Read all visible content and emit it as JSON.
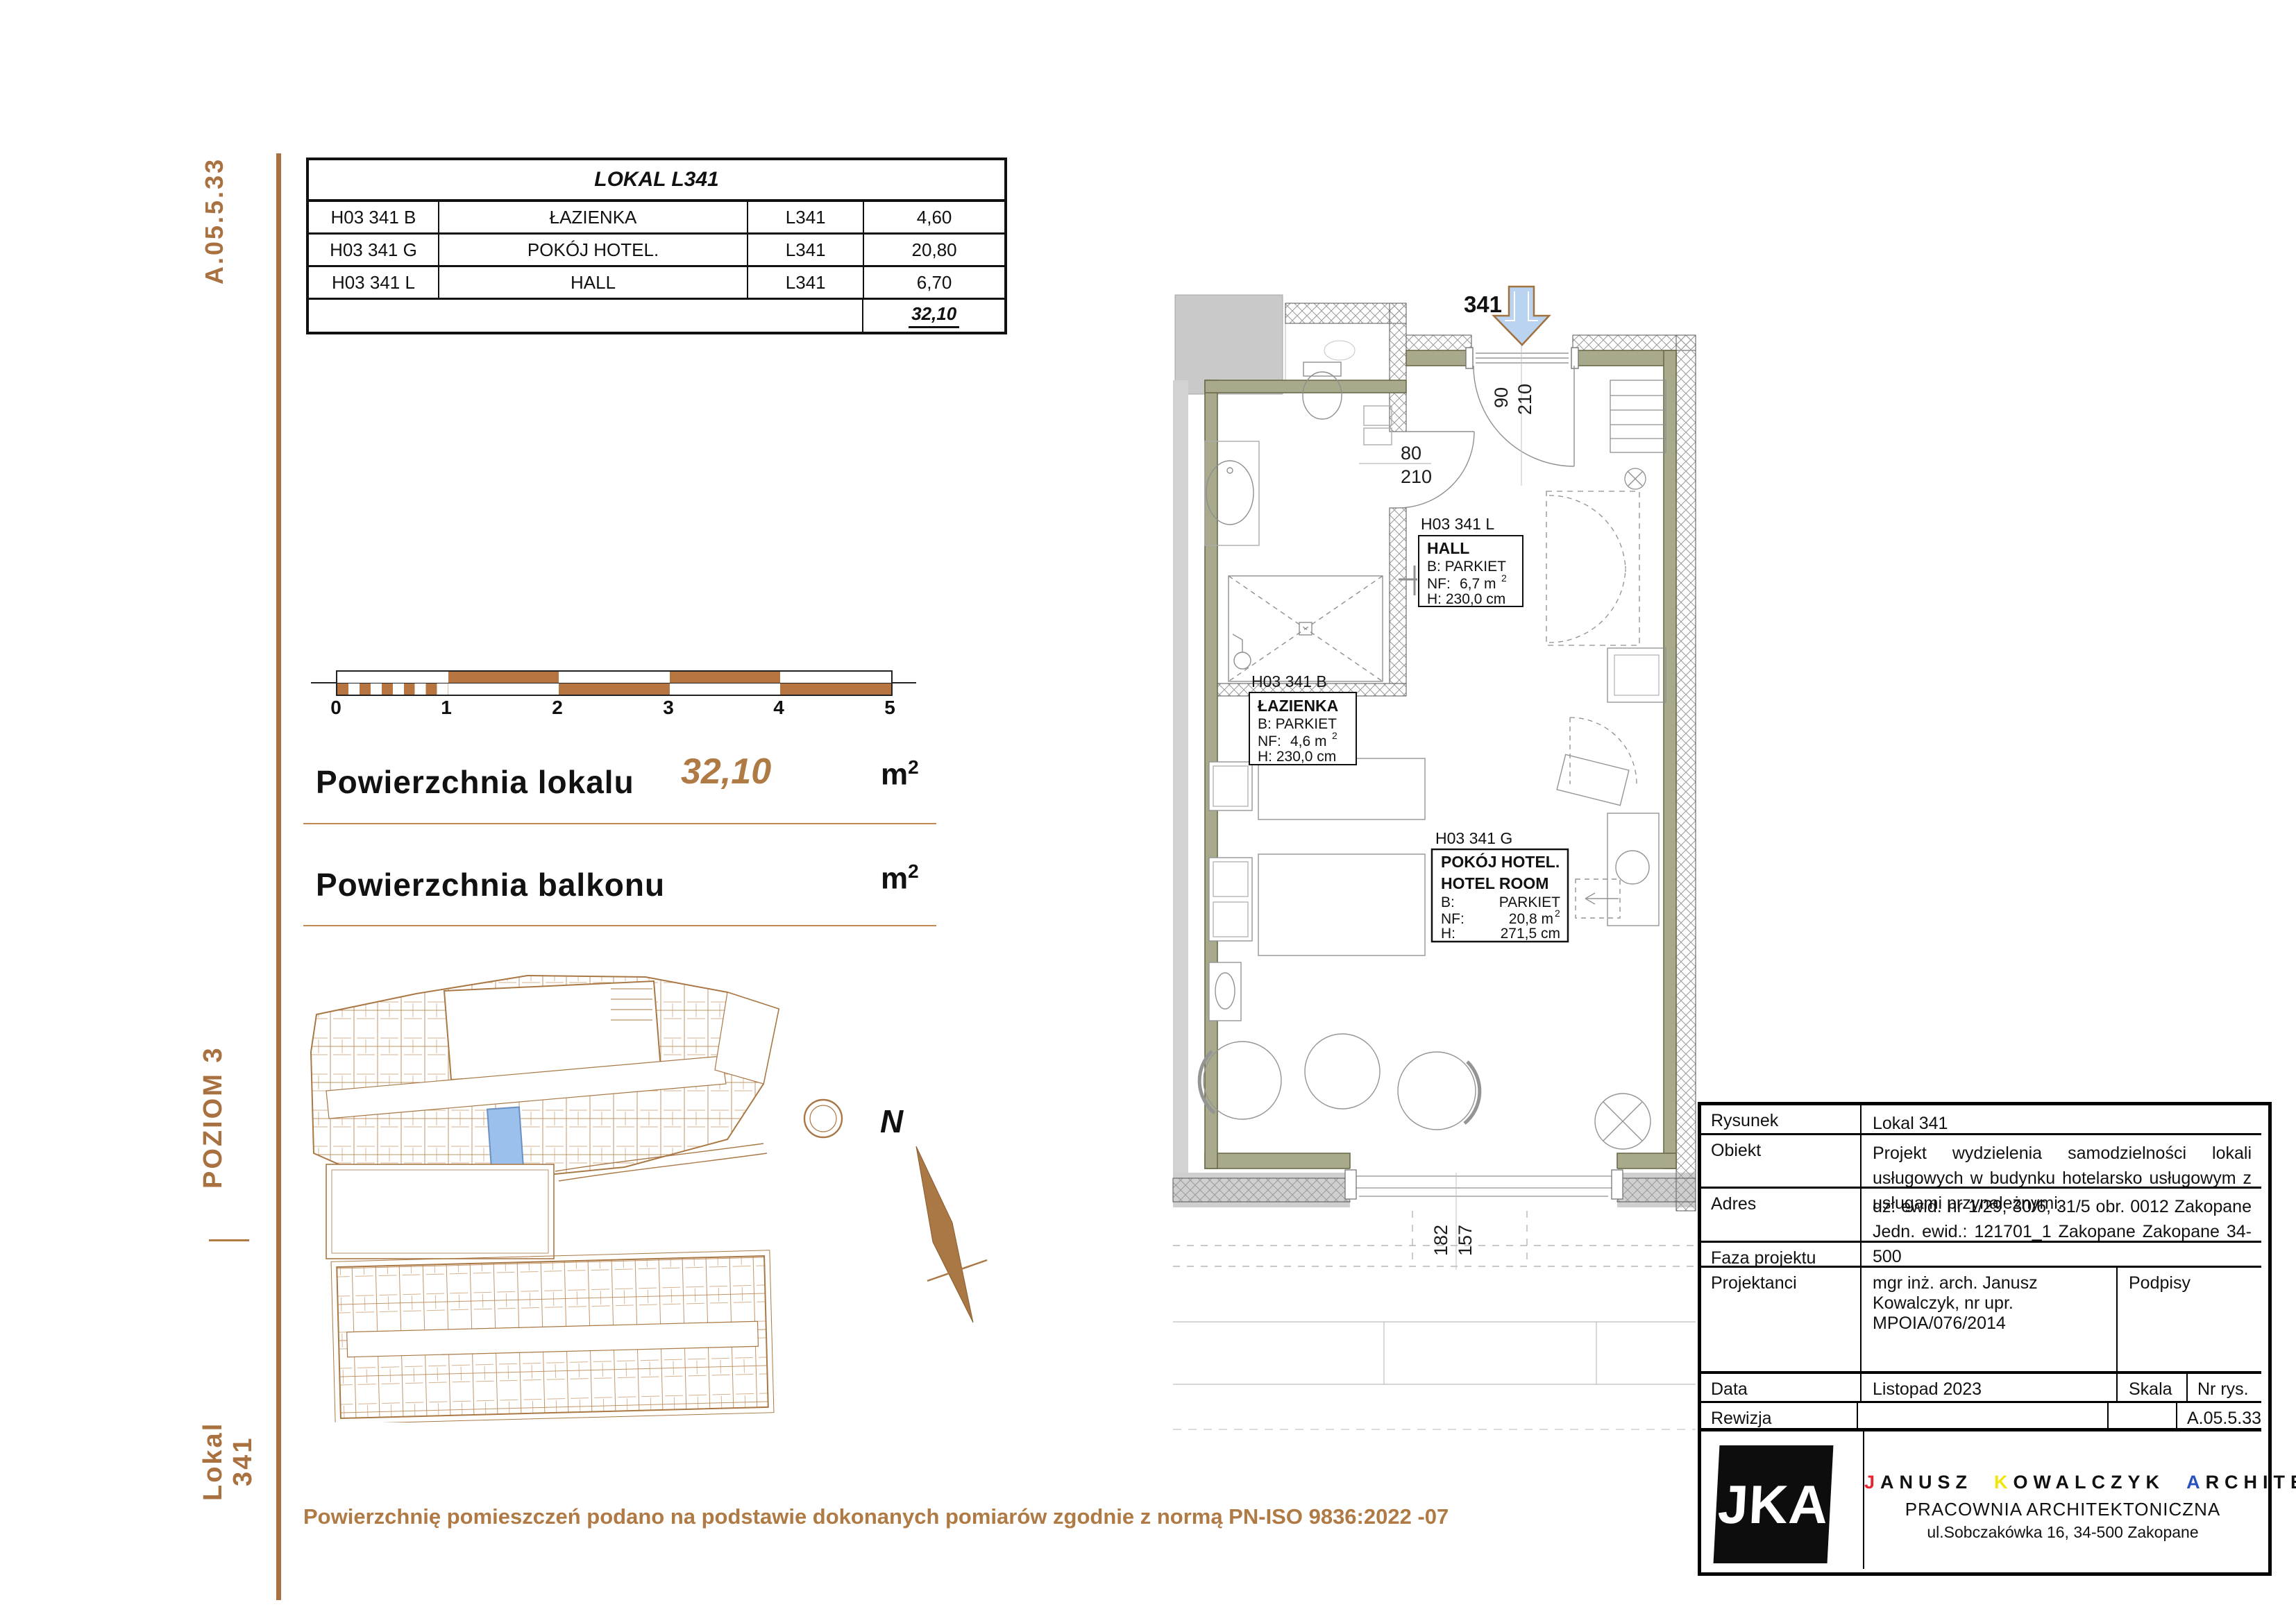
{
  "sidebar": {
    "drawing_no": "A.05.5.33",
    "level": "POZIOM 3",
    "unit": "Lokal 341"
  },
  "rooms_table": {
    "title": "LOKAL L341",
    "rows": [
      {
        "code": "H03 341 B",
        "name": "ŁAZIENKA",
        "unit": "L341",
        "area": "4,60"
      },
      {
        "code": "H03 341 G",
        "name": "POKÓJ HOTEL.",
        "unit": "L341",
        "area": "20,80"
      },
      {
        "code": "H03 341 L",
        "name": "HALL",
        "unit": "L341",
        "area": "6,70"
      }
    ],
    "total": "32,10"
  },
  "scale_bar": {
    "labels": [
      "0",
      "1",
      "2",
      "3",
      "4",
      "5"
    ]
  },
  "areas": {
    "local_label": "Powierzchnia lokalu",
    "local_value": "32,10",
    "balcony_label": "Powierzchnia balkonu",
    "unit_base": "m",
    "unit_exp": "2"
  },
  "plan": {
    "entrance_no": "341",
    "dims": {
      "entry_w": "90",
      "entry_h": "210",
      "bath_w": "80",
      "bath_h": "210",
      "balcony_w": "182",
      "balcony_h": "157"
    },
    "labels": {
      "hall": {
        "code": "H03 341 L",
        "name": "HALL",
        "floor": "B: PARKIET",
        "nf_l": "NF:",
        "nf_v": "6,7 m",
        "nf_exp": "2",
        "h": "H: 230,0 cm"
      },
      "bath": {
        "code": "H03 341 B",
        "name": "ŁAZIENKA",
        "floor": "B: PARKIET",
        "nf_l": "NF:",
        "nf_v": "4,6 m",
        "nf_exp": "2",
        "h": "H: 230,0 cm"
      },
      "room": {
        "code": "H03 341 G",
        "name": "POKÓJ HOTEL.",
        "name2": "HOTEL ROOM",
        "floor_l": "B:",
        "floor_v": "PARKIET",
        "nf_l": "NF:",
        "nf_v": "20,8 m",
        "nf_exp": "2",
        "h_l": "H:",
        "h_v": "271,5 cm"
      }
    }
  },
  "site": {
    "north_label": "N"
  },
  "title_block": {
    "rysunek_label": "Rysunek",
    "rysunek_value": "Lokal 341",
    "obiekt_label": "Obiekt",
    "obiekt_value": "Projekt wydzielenia samodzielności lokali usługowych w budynku hotelarsko usługowym z usługami przynależnymi.",
    "adres_label": "Adres",
    "adres_value": "dz. ewid. nr 1/29, 30/6, 31/5 obr. 0012 Zakopane Jedn. ewid.: 121701_1 Zakopane Zakopane 34-500",
    "faza_label": "Faza projektu",
    "projektanci_label": "Projektanci",
    "projektanci_value": "mgr inż. arch. Janusz Kowalczyk, nr upr. MPOIA/076/2014",
    "podpisy_label": "Podpisy",
    "data_label": "Data",
    "data_value": "Listopad 2023",
    "skala_label": "Skala",
    "nr_rys_label": "Nr rys.",
    "rewizja_label": "Rewizja",
    "nr_rys_value": "A.05.5.33",
    "logo_text": "JKA",
    "firm": {
      "p1_lead": "J",
      "p1_rest": "ANUSZ",
      "p2_lead": "K",
      "p2_rest": "OWALCZYK",
      "p3_lead": "A",
      "p3_rest": "RCHITEKT"
    },
    "firm_line2": "PRACOWNIA ARCHITEKTONICZNA",
    "firm_line3": "ul.Sobczakówka 16, 34-500 Zakopane"
  },
  "footnote": "Powierzchnię pomieszczeń podano na podstawie dokonanych pomiarów zgodnie z normą PN-ISO 9836:2022 -07",
  "colors": {
    "accent_brown": "#a9713f",
    "wall_olive": "#a9a98c",
    "highlight_blue": "#9cc0ec",
    "arrow_blue": "#b9d3f1"
  }
}
